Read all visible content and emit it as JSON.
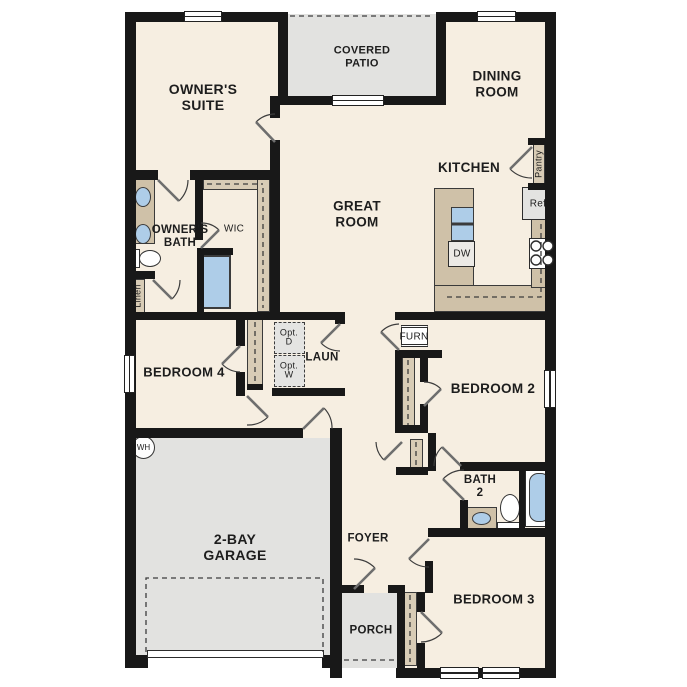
{
  "title": "Single-story 4-bedroom floor plan",
  "colors": {
    "floor": "#f6eee1",
    "wall": "#181818",
    "patio_garage_gray": "#e2e2e0",
    "counter_tan": "#cfc1a8",
    "closet_tan": "#d8ccb6",
    "fixture_blue": "#aecde8",
    "background": "#ffffff"
  },
  "labels": {
    "owners_suite": "OWNER'S\nSUITE",
    "covered_patio": "COVERED\nPATIO",
    "dining_room": "DINING\nROOM",
    "kitchen": "KITCHEN",
    "great_room": "GREAT\nROOM",
    "owners_bath": "OWNER'S\nBATH",
    "wic": "WIC",
    "linen": "Linen",
    "pantry": "Pantry",
    "ref": "Ref",
    "dw": "DW",
    "bedroom_4": "BEDROOM 4",
    "opt_d": "Opt.\nD",
    "opt_w": "Opt.\nW",
    "laundry": "LAUN",
    "furnace": "FURN",
    "bedroom_2": "BEDROOM 2",
    "bath_2": "BATH\n2",
    "water_heater": "WH",
    "garage": "2-BAY\nGARAGE",
    "foyer": "FOYER",
    "porch": "PORCH",
    "bedroom_3": "BEDROOM 3"
  }
}
